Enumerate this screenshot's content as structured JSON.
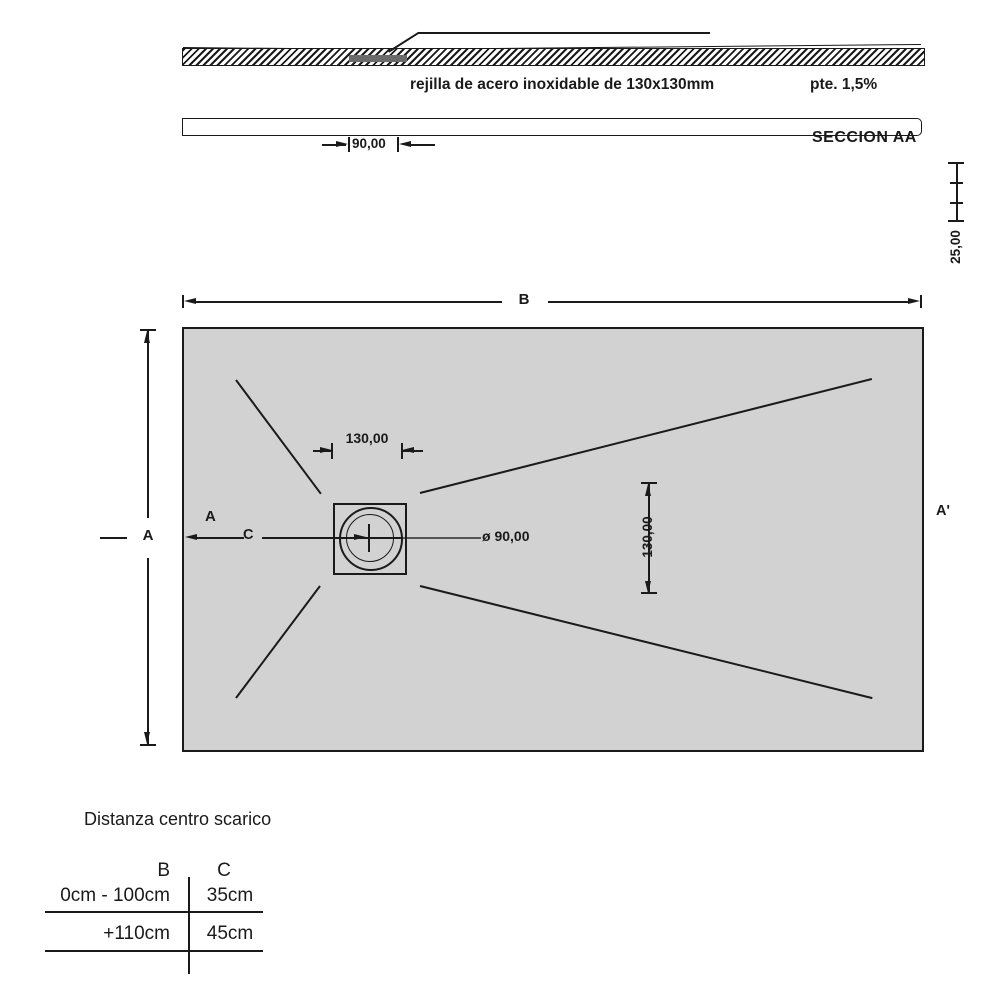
{
  "drawing": {
    "section": {
      "grate_note": "rejilla de acero inoxidable de 130x130mm",
      "slope_note": "pte. 1,5%",
      "view_label": "SECCION AA",
      "drain_width": "90,00",
      "depth_dim": "25,00"
    },
    "plan": {
      "dim_b": "B",
      "dim_a": "A",
      "cut_a": "A",
      "cut_a_end": "A'",
      "dim_c": "C",
      "drain_w": "130,00",
      "drain_h": "130,00",
      "drain_dia": "ø 90,00"
    },
    "table": {
      "title": "Distanza centro scarico",
      "header_b": "B",
      "header_c": "C",
      "rows": [
        {
          "b": "0cm - 100cm",
          "c": "35cm"
        },
        {
          "b": "+110cm",
          "c": "45cm"
        }
      ]
    },
    "colors": {
      "ink": "#1a1a1a",
      "tray_fill": "#d2d2d2",
      "centerline": "#555555"
    }
  }
}
